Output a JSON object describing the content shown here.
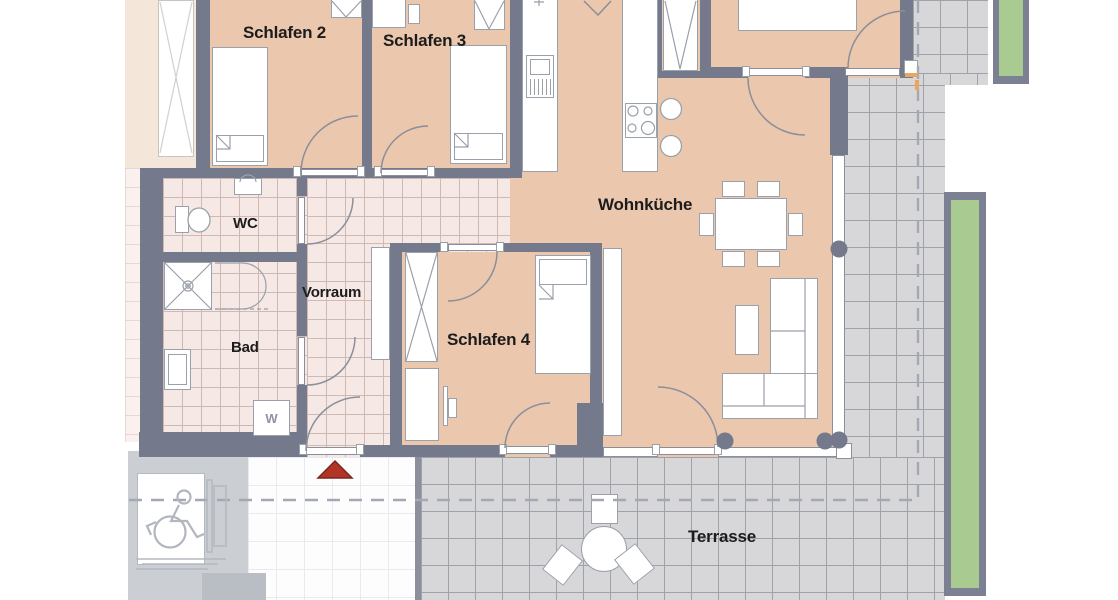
{
  "title": "Apartment floor plan",
  "rooms": {
    "schlafen2": {
      "label": "Schlafen 2"
    },
    "schlafen3": {
      "label": "Schlafen 3"
    },
    "schlafen4": {
      "label": "Schlafen 4"
    },
    "wohnkueche": {
      "label": "Wohnküche"
    },
    "wc": {
      "label": "WC"
    },
    "vorraum": {
      "label": "Vorraum"
    },
    "bad": {
      "label": "Bad"
    },
    "terrasse": {
      "label": "Terrasse"
    }
  },
  "appliances": {
    "washer_label": "W"
  },
  "icons": {
    "entrance": "entrance-arrow-icon",
    "lift": "wheelchair-lift-icon",
    "stove": "cooktop-icon",
    "sinks": "double-sink-icon",
    "shower": "shower-icon",
    "toilet": "toilet-icon"
  },
  "colors": {
    "peach": "#ebc7ae",
    "fadedPeach": "#f5e6da",
    "tilePink": "#f6e8e4",
    "tilePinkLine": "#cfb9b4",
    "wall": "#747a8c",
    "terraceTile": "#d7d7da",
    "terraceLine": "#9da2ab",
    "corridor": "#fdfdfe",
    "corridorLine": "#e9eaef",
    "green": "#a9ca90",
    "planterBorder": "#7b8192",
    "red": "#b23427",
    "shaft": "#cbced3",
    "furnStroke": "#9aa1aa",
    "labelColor": "#1c1c1c",
    "orange": "#e8a660"
  }
}
